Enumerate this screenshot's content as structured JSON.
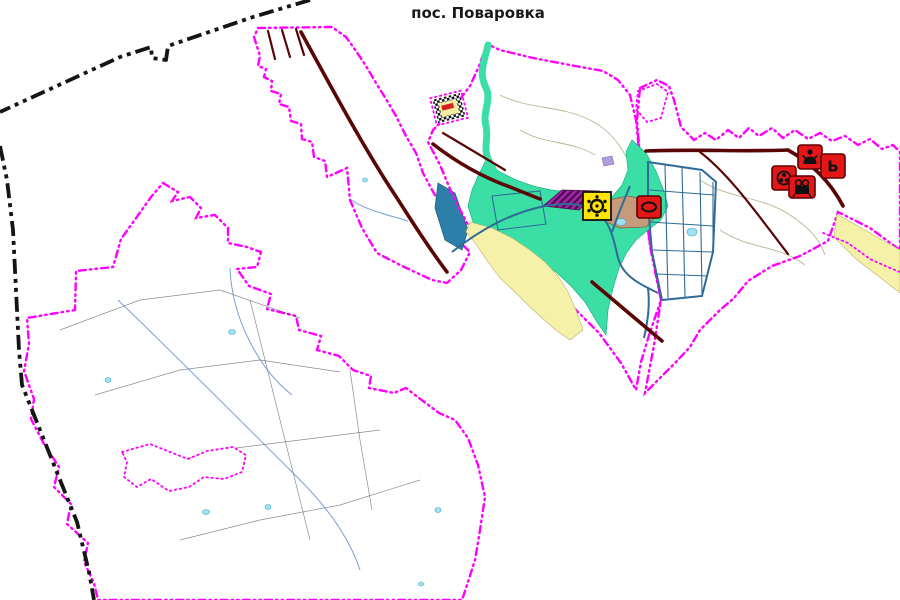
{
  "title": "пос. Поваровка",
  "colors": {
    "purple_fill": "#A221A5",
    "purple_hatch": "#460E4C",
    "orange_fill": "#EF7058",
    "orange_hatch": "#8F2012",
    "teal": "#3BDFA6",
    "pale_yellow": "#F6F1A8",
    "tan": "#C69B7B",
    "steel_blue": "#2C7FA8",
    "lavender": "#B39DDB",
    "boundary_black": "#151515",
    "zone_border_magenta": "#FF00FF",
    "road_dark_red": "#5A0606",
    "road_slate": "#2F6B96",
    "icon_red": "#E31717",
    "icon_yellow": "#FFE500",
    "glyph_black": "#111111",
    "pond_blue": "#9BE2F2"
  },
  "icons": [
    {
      "name": "gear-icon",
      "glyph": "ring-of-dots",
      "color_key": "icon_yellow"
    },
    {
      "name": "oval-icon",
      "glyph": "ellipse",
      "color_key": "icon_red"
    },
    {
      "name": "person-icon",
      "glyph": "person",
      "color_key": "icon_red"
    },
    {
      "name": "letter-icon",
      "glyph": "Ь",
      "color_key": "icon_red"
    },
    {
      "name": "film-reel-icon",
      "glyph": "reel",
      "color_key": "icon_red"
    },
    {
      "name": "projector-icon",
      "glyph": "projector",
      "color_key": "icon_red"
    },
    {
      "name": "checkered-object",
      "glyph": "checker-frame",
      "color_key": "pale_yellow"
    }
  ]
}
